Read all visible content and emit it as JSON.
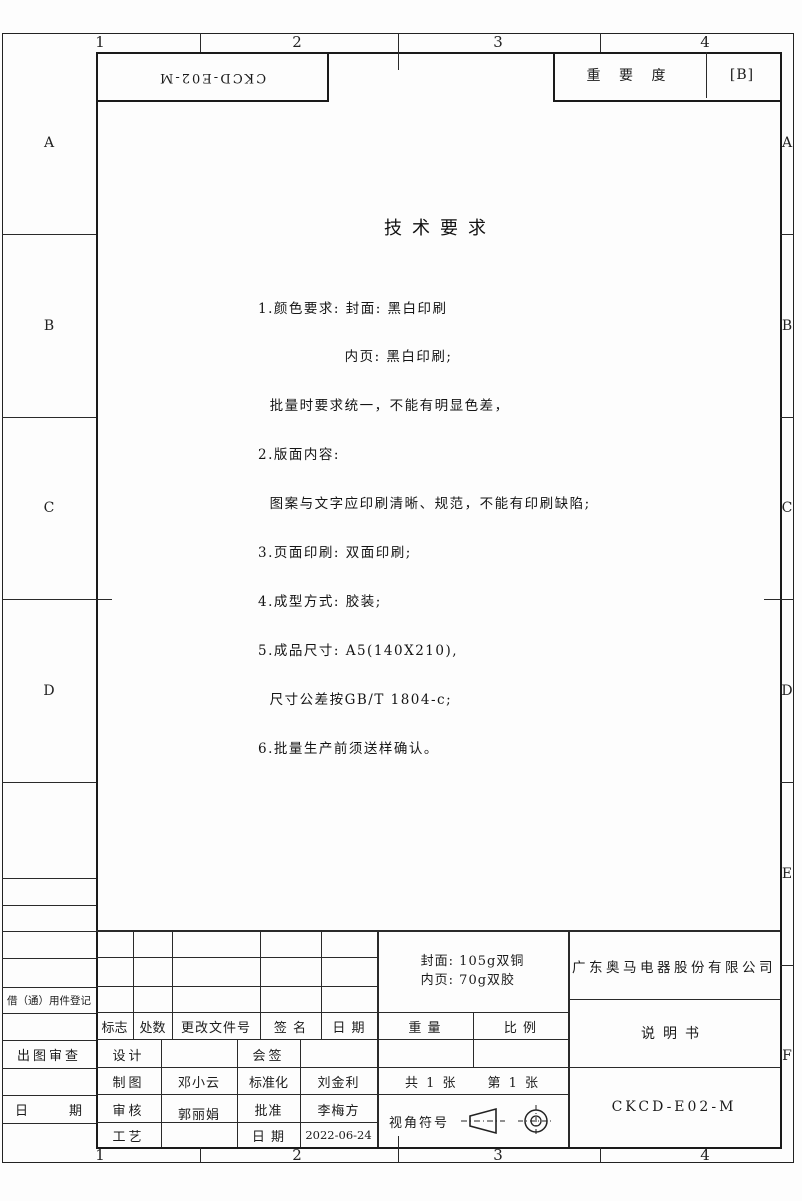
{
  "zones": {
    "top": [
      "1",
      "2",
      "3",
      "4"
    ],
    "bottom": [
      "1",
      "2",
      "3",
      "4"
    ],
    "left": [
      "A",
      "B",
      "C",
      "D"
    ],
    "right": [
      "A",
      "B",
      "C",
      "D",
      "E",
      "F"
    ]
  },
  "header": {
    "rotated_code": "CKCD-E02-M",
    "importance_label": "重 要 度",
    "importance_value": "[B]"
  },
  "tech": {
    "title": "技术要求",
    "lines": [
      "1.颜色要求: 封面: 黑白印刷",
      "　　　　　  内页: 黑白印刷;",
      "  批量时要求统一，不能有明显色差，",
      "2.版面内容:",
      "  图案与文字应印刷清晰、规范，不能有印刷缺陷;",
      "3.页面印刷: 双面印刷;",
      "4.成型方式: 胶装;",
      "5.成品尺寸: A5(140X210),",
      "  尺寸公差按GB/T 1804-c;",
      "6.批量生产前须送样确认。"
    ]
  },
  "left_margin": {
    "borrow_label": "借（通）用件登记",
    "review_label": "出图审查",
    "date_left": "日",
    "date_right": "期"
  },
  "revision": {
    "mark": "标志",
    "count": "处数",
    "doc_no": "更改文件号",
    "sign": "签 名",
    "date": "日 期"
  },
  "roles": {
    "design": "设计",
    "countersign": "会签",
    "draft": "制图",
    "draft_name": "邓小云",
    "standard": "标准化",
    "standard_name": "刘金利",
    "check": "审核",
    "check_name": "郭丽娟",
    "approve": "批准",
    "approve_name": "李梅方",
    "process": "工艺",
    "date": "日 期",
    "date_value": "2022-06-24"
  },
  "block": {
    "paper_line1": "封面: 105g双铜",
    "paper_line2": "内页: 70g双胶",
    "weight": "重 量",
    "scale": "比 例",
    "company": "广东奥马电器股份有限公司",
    "doc_type": "说明书",
    "sheets_total": "共 1 张",
    "sheet_no": "第 1 张",
    "view_label": "视角符号",
    "code": "CKCD-E02-M"
  }
}
